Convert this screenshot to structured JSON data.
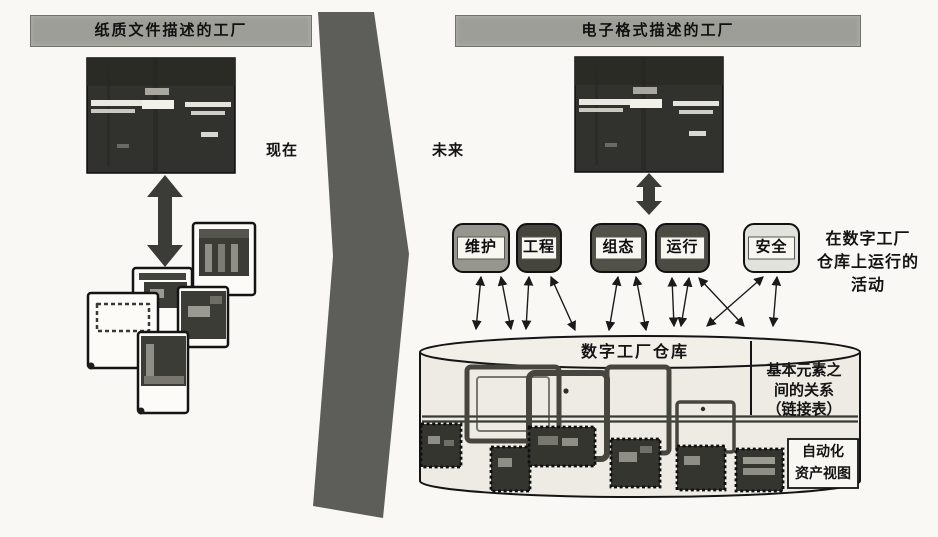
{
  "figure": {
    "kind": "scanned-book-diagram",
    "now_label": "现在",
    "future_label": "未来"
  },
  "left_panel": {
    "header": "纸质文件描述的工厂",
    "photo": "factory-photo",
    "documents": "paper-drawing-stack"
  },
  "right_panel": {
    "header": "电子格式描述的工厂",
    "photo": "factory-photo",
    "activity_buttons": [
      {
        "label": "维护",
        "bg": "#96968e"
      },
      {
        "label": "工程",
        "bg": "#45453e"
      },
      {
        "label": "组态",
        "bg": "#51514a"
      },
      {
        "label": "运行",
        "bg": "#4b4b44"
      },
      {
        "label": "安全",
        "bg": "#e2e2dc"
      }
    ],
    "activities_note": "在数字工厂\n仓库上运行的\n活动",
    "warehouse": {
      "title": "数字工厂仓库",
      "relations_label": "基本元素之\n间的关系\n（链接表）",
      "assets_label": "自动化\n资产视图"
    }
  },
  "icons": {
    "exchange_arrow": "vertical-double-headed-arrow",
    "link_arrow": "thin-double-headed-arrow"
  },
  "colors": {
    "paper": "#f9f8f4",
    "header_bg": "#9e9e98",
    "divider_band": "#5d5d59",
    "ink": "#141414",
    "photo_dark": "#31312d",
    "cylinder_fill": "#edebe4",
    "cylinder_top": "#f1efe8",
    "frame_stroke": "#46463f",
    "block_fill": "#35352f",
    "button_strip": "#f7f6f1"
  }
}
